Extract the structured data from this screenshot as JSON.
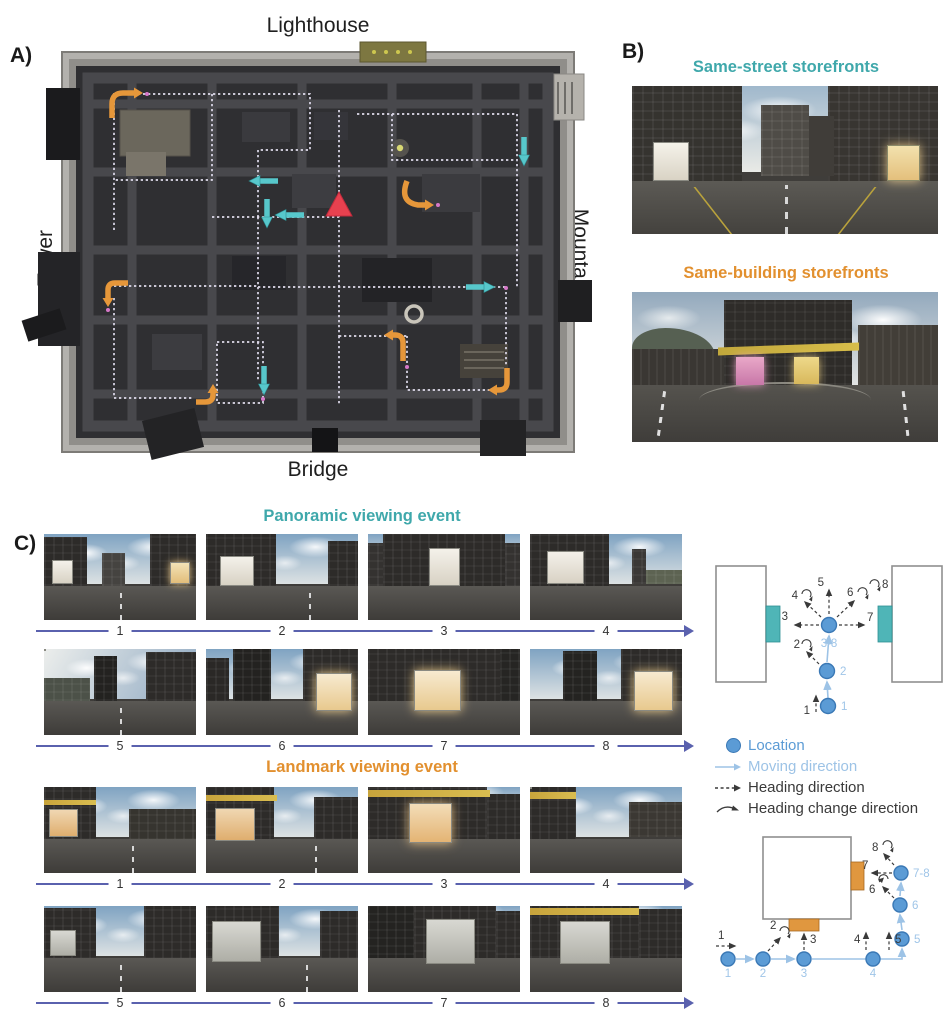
{
  "panel_a": {
    "label": "A)",
    "landmark_top": "Lighthouse",
    "landmark_left": "Tower",
    "landmark_right": "Mountain",
    "landmark_bottom": "Bridge"
  },
  "panel_b": {
    "label": "B)",
    "sections": [
      {
        "title": "Same-street storefronts"
      },
      {
        "title": "Same-building storefronts"
      }
    ]
  },
  "panel_c": {
    "label": "C)",
    "events": [
      {
        "title": "Panoramic viewing event",
        "rows": [
          {
            "steps": [
              "1",
              "2",
              "3",
              "4"
            ]
          },
          {
            "steps": [
              "5",
              "6",
              "7",
              "8"
            ]
          }
        ]
      },
      {
        "title": "Landmark viewing event",
        "rows": [
          {
            "steps": [
              "1",
              "2",
              "3",
              "4"
            ]
          },
          {
            "steps": [
              "5",
              "6",
              "7",
              "8"
            ]
          }
        ]
      }
    ]
  },
  "diagram_panoramic": {
    "heading_steps": [
      "1",
      "2",
      "3",
      "4",
      "5",
      "6",
      "7",
      "8"
    ],
    "locations": [
      "1",
      "2",
      "3-8"
    ]
  },
  "diagram_landmark": {
    "heading_steps": [
      "1",
      "2",
      "3",
      "4",
      "5",
      "6",
      "7",
      "8"
    ],
    "locations": [
      "1",
      "2",
      "3",
      "4",
      "5",
      "6",
      "7-8"
    ]
  },
  "legend": {
    "items": [
      "Location",
      "Moving direction",
      "Heading direction",
      "Heading change direction"
    ]
  },
  "colors": {
    "teal_heading": "#3fa8ab",
    "orange_heading": "#e2902f",
    "location_blue": "#5b9bd5",
    "moving_blue": "#9dc3e6",
    "sequence_arrow": "#5a61ae",
    "map_teal_arrow": "#57c7cb",
    "map_orange_arrow": "#e6973a",
    "start_marker_red": "#e8414f",
    "storefront_teal": "#4fb5b7",
    "storefront_orange": "#e0973f"
  }
}
